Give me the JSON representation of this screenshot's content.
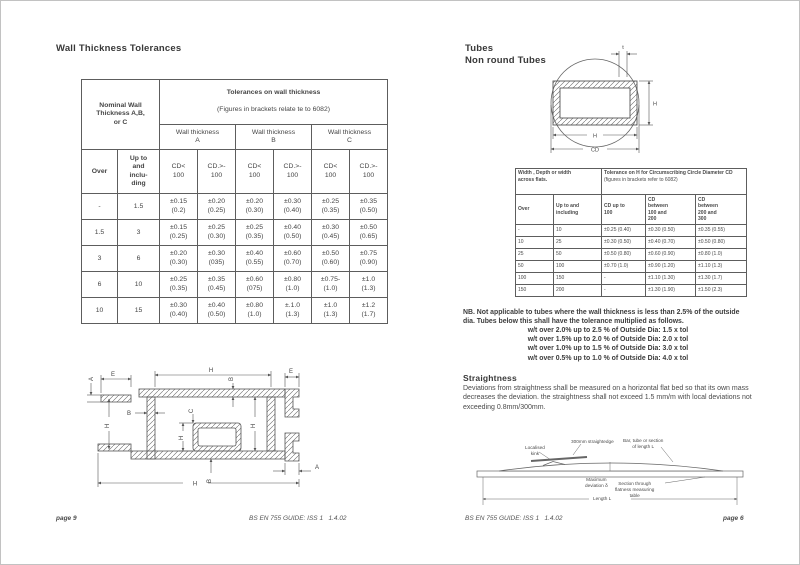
{
  "colors": {
    "background": "#ffffff",
    "text": "#3f3f3f",
    "line": "#5a5a5a",
    "frame": "#c2c2c2"
  },
  "left_page": {
    "heading": "Wall Thickness Tolerances",
    "tolerance_table": {
      "corner_header": "Nominal Wall\nThickness A,B,\nor C",
      "main_header_bold": "Tolerances on wall thickness",
      "main_header_sub": "(Figures in brackets relate te to 6082)",
      "group_headers": [
        "Wall thickness\nA",
        "Wall thickness\nB",
        "Wall thickness\nC"
      ],
      "over_header": "Over",
      "upto_header": "Up to\nand\ninclu-\nding",
      "cd_headers": [
        "CD<\n100",
        "CD.>-\n100",
        "CD<\n100",
        "CD.>-\n100",
        "CD<\n100",
        "CD.>-\n100"
      ],
      "rows": [
        [
          "-",
          "1.5",
          "±0.15\n(0.2)",
          "±0.20\n(0.25)",
          "±0.20\n(0.30)",
          "±0.30\n(0.40)",
          "±0.25\n(0.35)",
          "±0.35\n(0.50)"
        ],
        [
          "1.5",
          "3",
          "±0.15\n(0.25)",
          "±0.25\n(0.30)",
          "±0.25\n(0.35)",
          "±0.40\n(0.50)",
          "±0.30\n(0.45)",
          "±0.50\n(0.65)"
        ],
        [
          "3",
          "6",
          "±0.20\n(0.30)",
          "±0.30\n(035)",
          "±0.40\n(0.55)",
          "±0.60\n(0.70)",
          "±0.50\n(0.60)",
          "±0.75\n(0.90)"
        ],
        [
          "6",
          "10",
          "±0.25\n(0.35)",
          "±0.35\n(0.45)",
          "±0.60\n(075)",
          "±0.80\n(1.0)",
          "±0.75-\n(1.0)",
          "±1.0\n(1.3)"
        ],
        [
          "10",
          "15",
          "±0.30\n(0.40)",
          "±0.40\n(0.50)",
          "±0.80\n(1.0)",
          "±.1.0\n(1.3)",
          "±1.0\n(1.3)",
          "±1.2\n(1.7)"
        ]
      ]
    },
    "profile_labels": {
      "e": "E",
      "h": "H",
      "a": "A",
      "b": "B",
      "c": "C"
    },
    "footer_page": "page 9",
    "footer_doc": "BS EN 755 GUIDE: ISS 1   1.4.02"
  },
  "right_page": {
    "heading_line1": "Tubes",
    "heading_line2": "Non round Tubes",
    "tube_labels": {
      "t": "t",
      "h_right": "H",
      "h_bottom": "H",
      "cd": "CD"
    },
    "cc_table": {
      "corner_header": "Width , Depth or width\nacross flats.",
      "main_header_bold": "Tolerance on H for Circumscribing Circle Diameter CD",
      "main_header_sub": "(figures in brackets refer to 6082)",
      "col_headers": [
        "Over",
        "Up to and\nincluding",
        "CD up to\n100",
        "CD\nbetween\n100 and\n200",
        "CD\nbetween\n200 and\n300"
      ],
      "rows": [
        [
          "-",
          "10",
          "±0.25 (0.40)",
          "±0.30 (0.50)",
          "±0.35 (0.55)"
        ],
        [
          "10",
          "25",
          "±0.30 (0.50)",
          "±0.40 (0.70)",
          "±0.50 (0.80)"
        ],
        [
          "25",
          "50",
          "±0.50 (0.80)",
          "±0.60 (0.90)",
          "±0.80 (1.0)"
        ],
        [
          "50",
          "100",
          "±0.70 (1.0)",
          "±0.90 (1.20)",
          "±1.10 (1.3)"
        ],
        [
          "100",
          "150",
          "-",
          "±1.10 (1.30)",
          "±1.30 (1.7)"
        ],
        [
          "150",
          "200",
          "-",
          "±1.30 (1.90)",
          "±1.50 (2.3)"
        ]
      ]
    },
    "nb": {
      "intro": "NB. Not applicable to tubes where the wall thickness is less than 2.5% of the outside dia. Tubes below this shall have the tolerance multiplied as follows.",
      "lines": [
        "w/t over 2.0% up to 2.5 % of Outside Dia: 1.5 x tol",
        "w/t over 1.5% up to 2.0 % of Outside Dia: 2.0 x tol",
        "w/t over 1.0% up to 1.5 % of Outside Dia: 3.0 x tol",
        "w/t over 0.5% up to 1.0 % of Outside Dia: 4.0 x tol"
      ]
    },
    "straightness": {
      "heading": "Straightness",
      "body": "Deviations from straightness shall be measured on a horizontal flat bed so that its own mass decreases the deviation. the straightness shall not exceed 1.5 mm/m with local deviations not exceeding 0.8mm/300mm."
    },
    "straightness_labels": {
      "kink": "Localised\nkink",
      "straightedge": "300mm straightedge",
      "bar": "Bar, tube or section\nof length L",
      "max_dev": "Maximum\ndeviation δ",
      "section": "Section through\nflatness measuring\ntable",
      "length": "Length L"
    },
    "footer_doc": "BS EN 755 GUIDE: ISS 1   1.4.02",
    "footer_page": "page 6"
  }
}
